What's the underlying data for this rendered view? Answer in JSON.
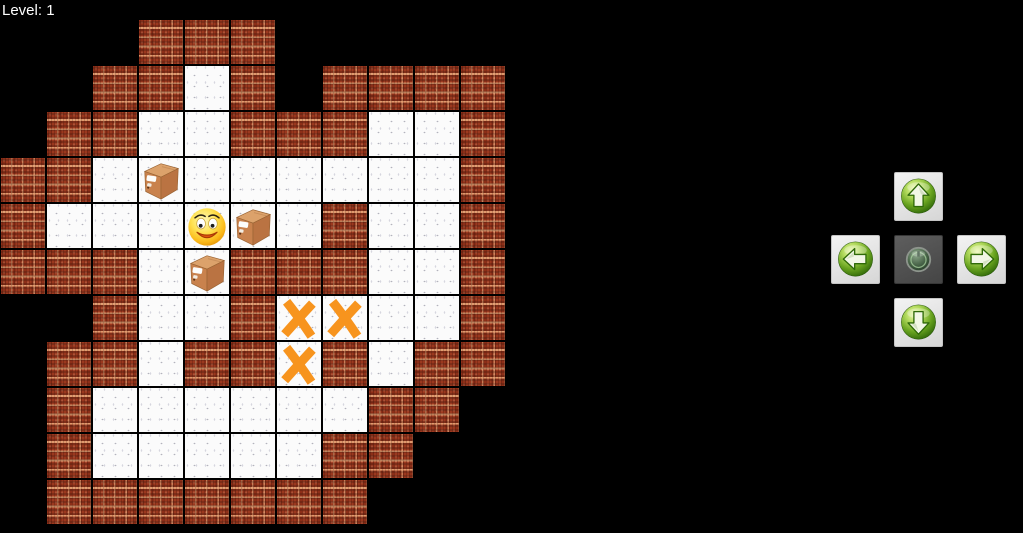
{
  "hud": {
    "level_label": "Level: 1"
  },
  "board": {
    "grid_cols": 11,
    "grid_rows": 11,
    "tile_size_px": 46,
    "legend": {
      "#": "wall",
      ".": "floor",
      " ": "empty",
      "B": "box",
      "P": "player",
      "X": "target"
    },
    "rows": [
      "   ###     ",
      "  ##.# ####",
      " ##..###..#",
      "##.B......#",
      "#...PB.#..#",
      "###.B###..#",
      "  #..#XX..#",
      " ##.##X#.##",
      " #......## ",
      " #.....##  ",
      " #######   "
    ],
    "entities": {
      "player": {
        "row": 4,
        "col": 4
      },
      "boxes": [
        {
          "row": 3,
          "col": 3
        },
        {
          "row": 4,
          "col": 5
        },
        {
          "row": 5,
          "col": 4
        }
      ],
      "targets": [
        {
          "row": 6,
          "col": 6
        },
        {
          "row": 6,
          "col": 7
        },
        {
          "row": 7,
          "col": 6
        }
      ]
    }
  },
  "controls": {
    "buttons": [
      {
        "id": "up",
        "name": "move-up-button",
        "icon": "arrow-up-icon"
      },
      {
        "id": "left",
        "name": "move-left-button",
        "icon": "arrow-left-icon"
      },
      {
        "id": "center",
        "name": "reset-button",
        "icon": "reset-power-icon"
      },
      {
        "id": "right",
        "name": "move-right-button",
        "icon": "arrow-right-icon"
      },
      {
        "id": "down",
        "name": "move-down-button",
        "icon": "arrow-down-icon"
      }
    ]
  },
  "colors": {
    "background": "#000000",
    "brick": "#a23a1f",
    "mortar": "#f0a576",
    "floor": "#fbfbfb",
    "grid_line": "#000000",
    "target_orange": "#f7941e",
    "crate_brown": "#c9824d",
    "player_yellow": "#ffd24a",
    "button_green": "#68a31f",
    "button_plate": "#e6e6e6",
    "center_plate": "#4e4e4e"
  }
}
